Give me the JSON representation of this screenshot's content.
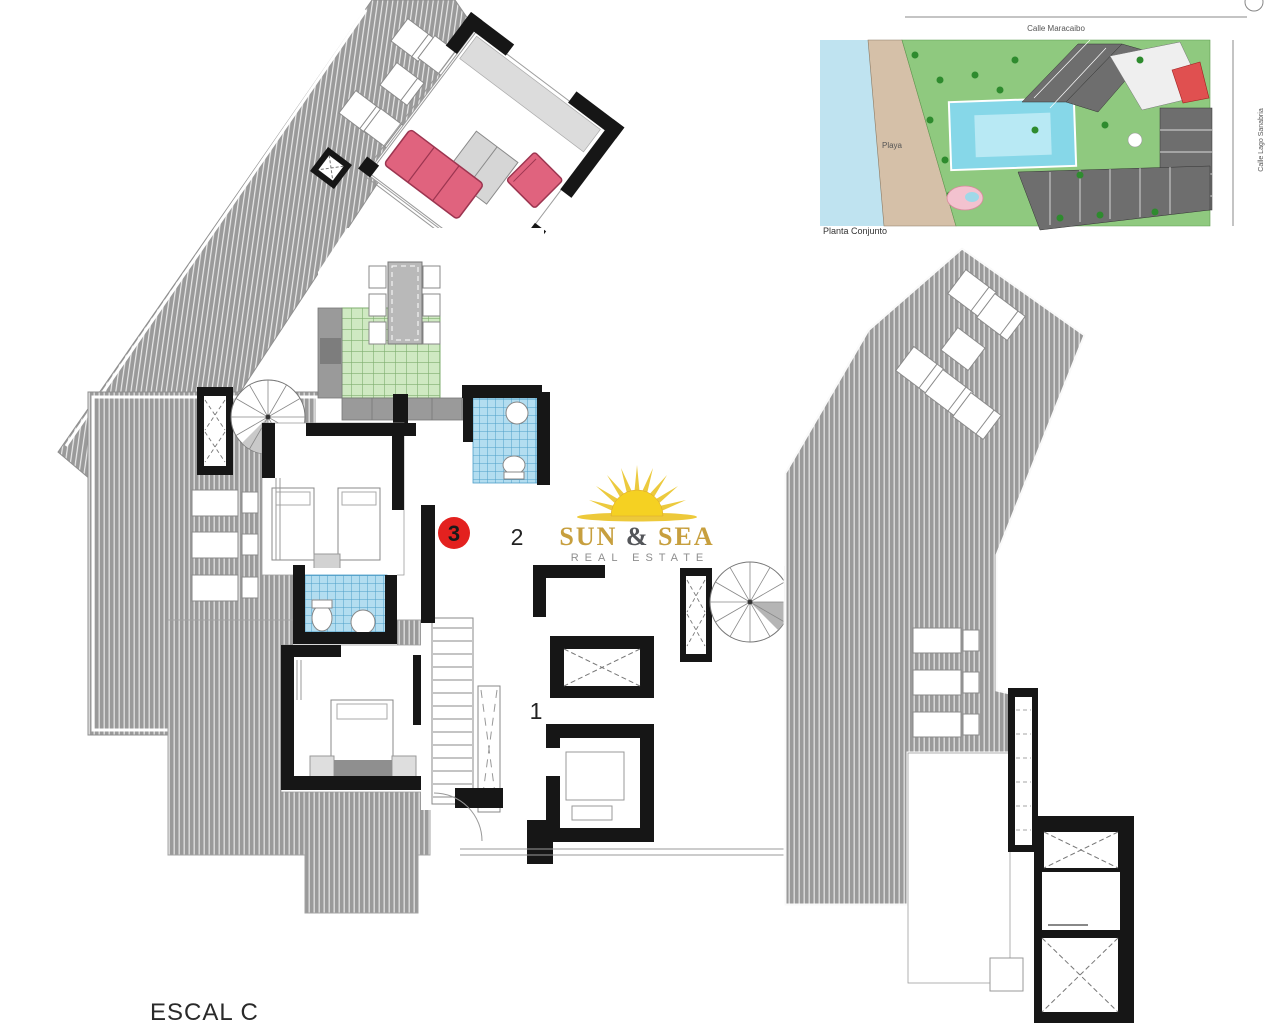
{
  "page": {
    "background": "#ffffff"
  },
  "floor_plan": {
    "title": "ESCAL C",
    "unit_markers": {
      "unit3": "3",
      "unit2": "2",
      "unit1": "1"
    }
  },
  "logo": {
    "word1": "SUN",
    "ampersand": "&",
    "word2": "SEA",
    "tagline": "REAL ESTATE"
  },
  "site_plan": {
    "caption": "Planta Conjunto",
    "beach_label": "Playa",
    "street_top": "Calle Maracaibo",
    "street_right": "Calle Lago Sanabria"
  },
  "colors": {
    "deck_gray": "#9a9a9a",
    "wall_black": "#161616",
    "sofa_red": "#e0637e",
    "sofa_stroke": "#9c3550",
    "unit_red": "#e3211f",
    "kitchen_green": "#cfe9c2",
    "bath_blue": "#b3ddf0",
    "counter_gray": "#9a9a9a",
    "furniture_gray": "#d6d6d6",
    "logo_gold": "#c79f3e",
    "logo_gray": "#8e8e8e",
    "sun_yellow": "#f5d122",
    "sea_water": "#bfe3f0",
    "beach_sand": "#d5c0a8",
    "site_green": "#8fc97f",
    "pool_cyan": "#86d7e8"
  }
}
